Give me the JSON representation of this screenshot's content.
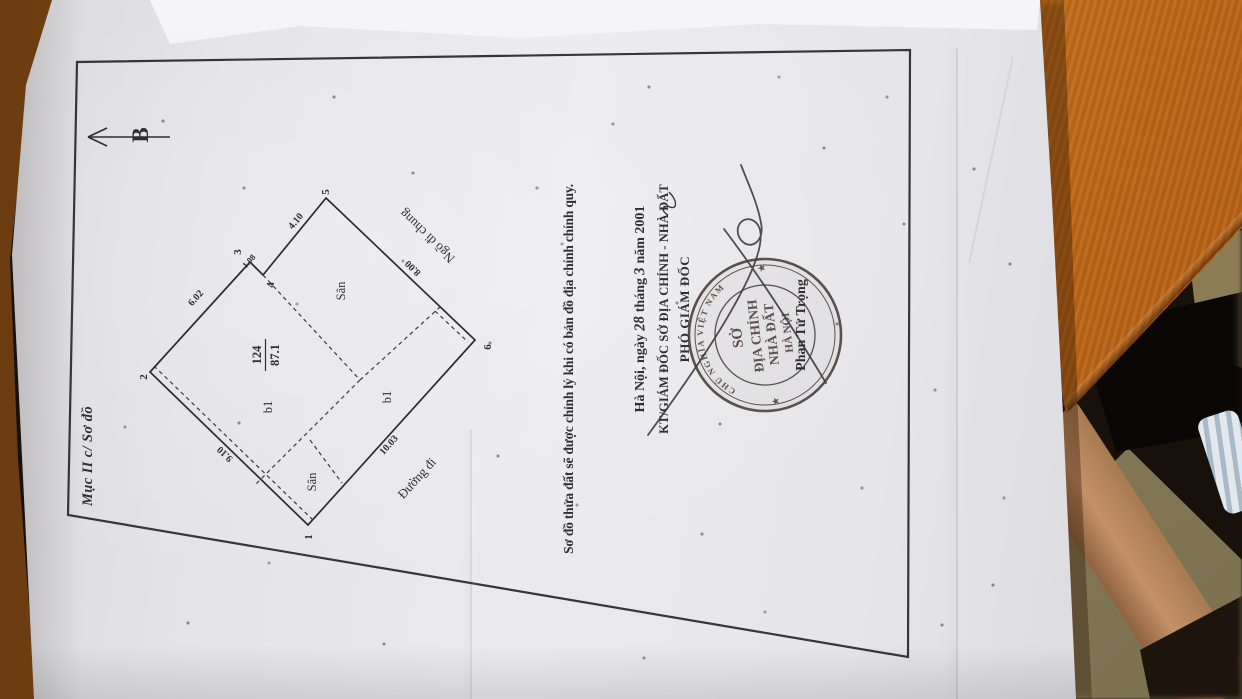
{
  "colors": {
    "paper": "#e7e7ea",
    "ink": "#2f2f33",
    "stamp_ink": "#4a3a33",
    "desk_orange": "#c06a1c",
    "floor_khaki": "#8a7c55",
    "skin": "#b5835c",
    "fabric_blue": "#c9d4dd"
  },
  "document": {
    "corner_label": "Mục II c/ Sơ đồ",
    "north_label": "B",
    "map": {
      "vertex_labels": [
        "1",
        "2",
        "3",
        "4",
        "5",
        "6"
      ],
      "edge_lengths": [
        "9.10",
        "6.02",
        "1.08",
        "4.10",
        "8.00",
        "10.03"
      ],
      "parcel_number": "124",
      "parcel_area": "87.1",
      "region_labels": [
        "Sân",
        "b1",
        "b1",
        "Sân"
      ],
      "alley_label": "Ngõ đi chung",
      "road_label": "Đường đi"
    },
    "note": "Sơ đồ thửa đất sẽ được chỉnh lý khi có bản đồ địa chính chính quy.",
    "date": {
      "prefix": "Hà Nội, ngày",
      "day": "28",
      "month_word": "tháng",
      "month": "3",
      "year_word": "năm 2001"
    },
    "signing": {
      "title": "KT/GIÁM ĐỐC SỞ ĐỊA CHÍNH - NHÀ ĐẤT",
      "subtitle": "PHÓ GIÁM ĐỐC",
      "signer": "Phan Tử Trọng"
    },
    "stamp": {
      "ring_text": "CHỦ NGHĨA VIỆT NAM",
      "star": "★",
      "line1": "SỞ",
      "line2": "ĐỊA CHÍNH",
      "line3": "NHÀ ĐẤT",
      "line4": "HÀ NỘI"
    }
  }
}
